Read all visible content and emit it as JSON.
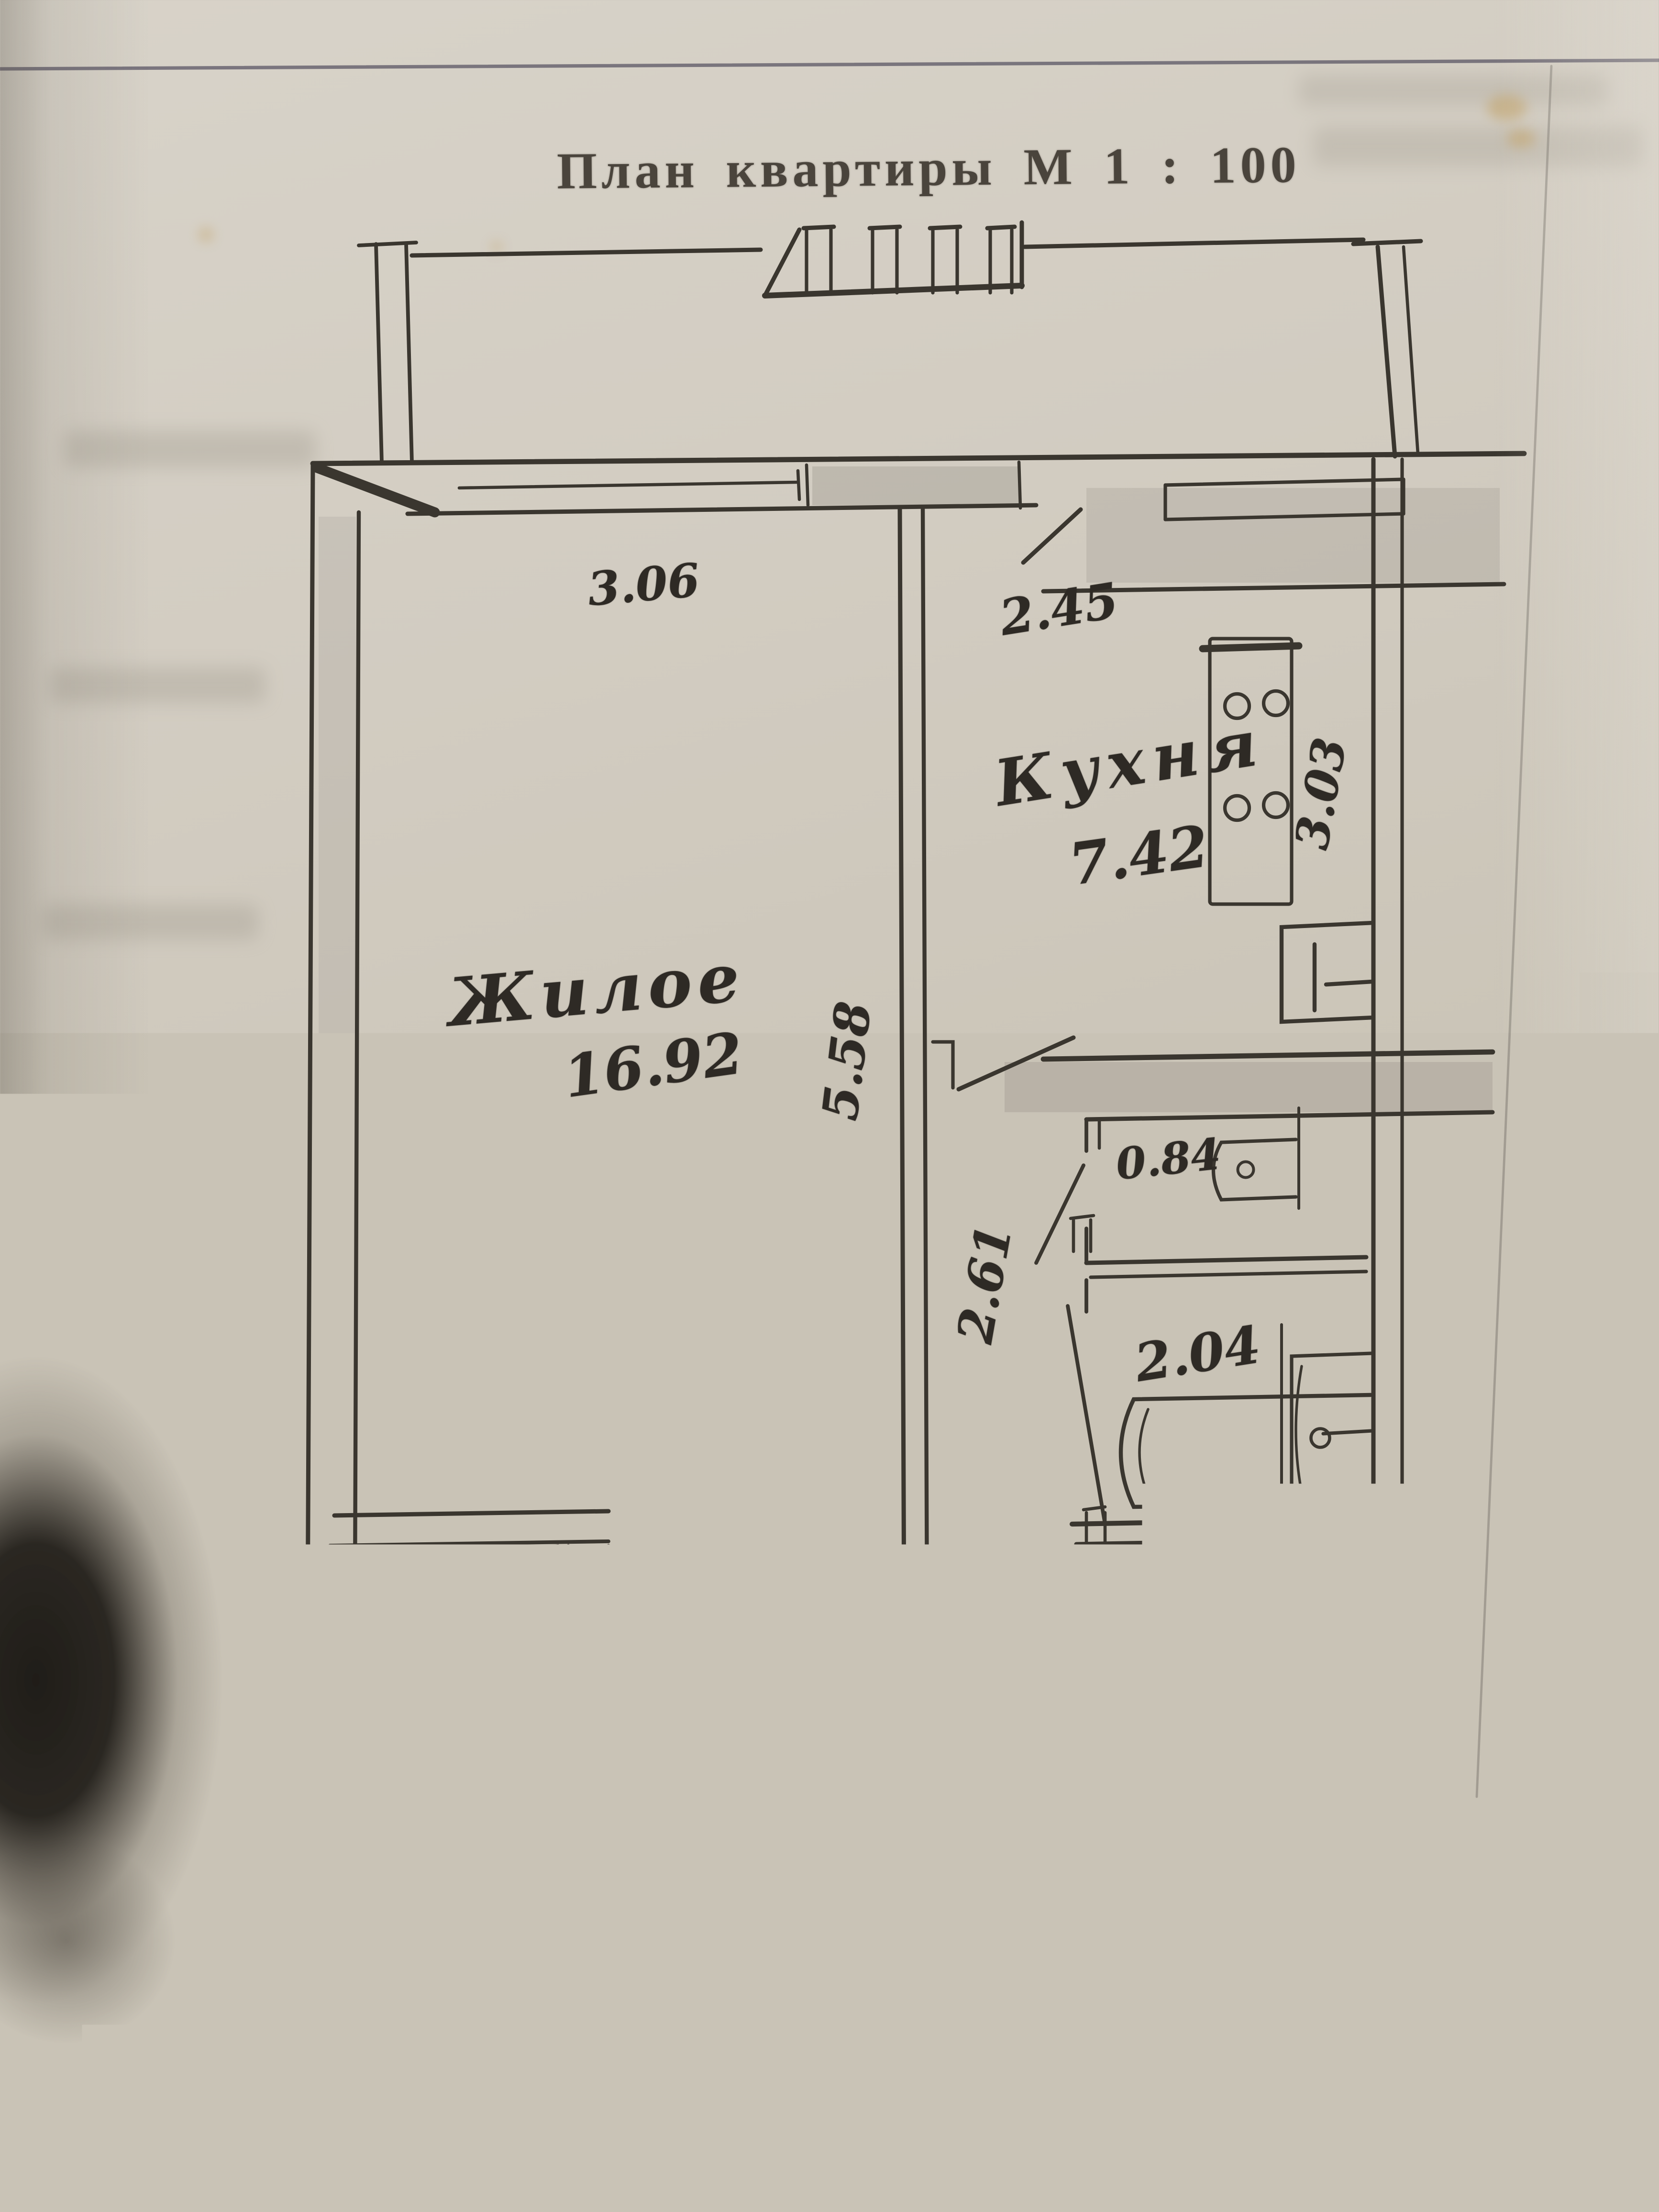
{
  "title": "План квартиры М 1 : 100",
  "caption": "ационный план расположения жилого дома и квартиры",
  "watermark": "Realt",
  "rooms": {
    "living": {
      "name": "Жилое",
      "area": "16.92"
    },
    "kitchen": {
      "name": "Кухня",
      "area": "7.42"
    },
    "corridor": {
      "name": "Кор-р",
      "area": "8.27"
    },
    "closet": {
      "area": "1.47"
    },
    "wc": {
      "area": "0.84"
    },
    "bath": {
      "area": "2.04"
    }
  },
  "dimensions": {
    "living_window_width": "3.06",
    "kitchen_window_width": "2.45",
    "kitchen_depth": "3.03",
    "living_length": "5.58",
    "hall_width": "2.61",
    "closet_width": "1.05",
    "closet_depth": "1.40"
  },
  "colors": {
    "paper": "#cdc7bb",
    "ink": "#3a362f",
    "shadow_blob": "#1f1c17",
    "watermark": "#f2f0ea"
  }
}
